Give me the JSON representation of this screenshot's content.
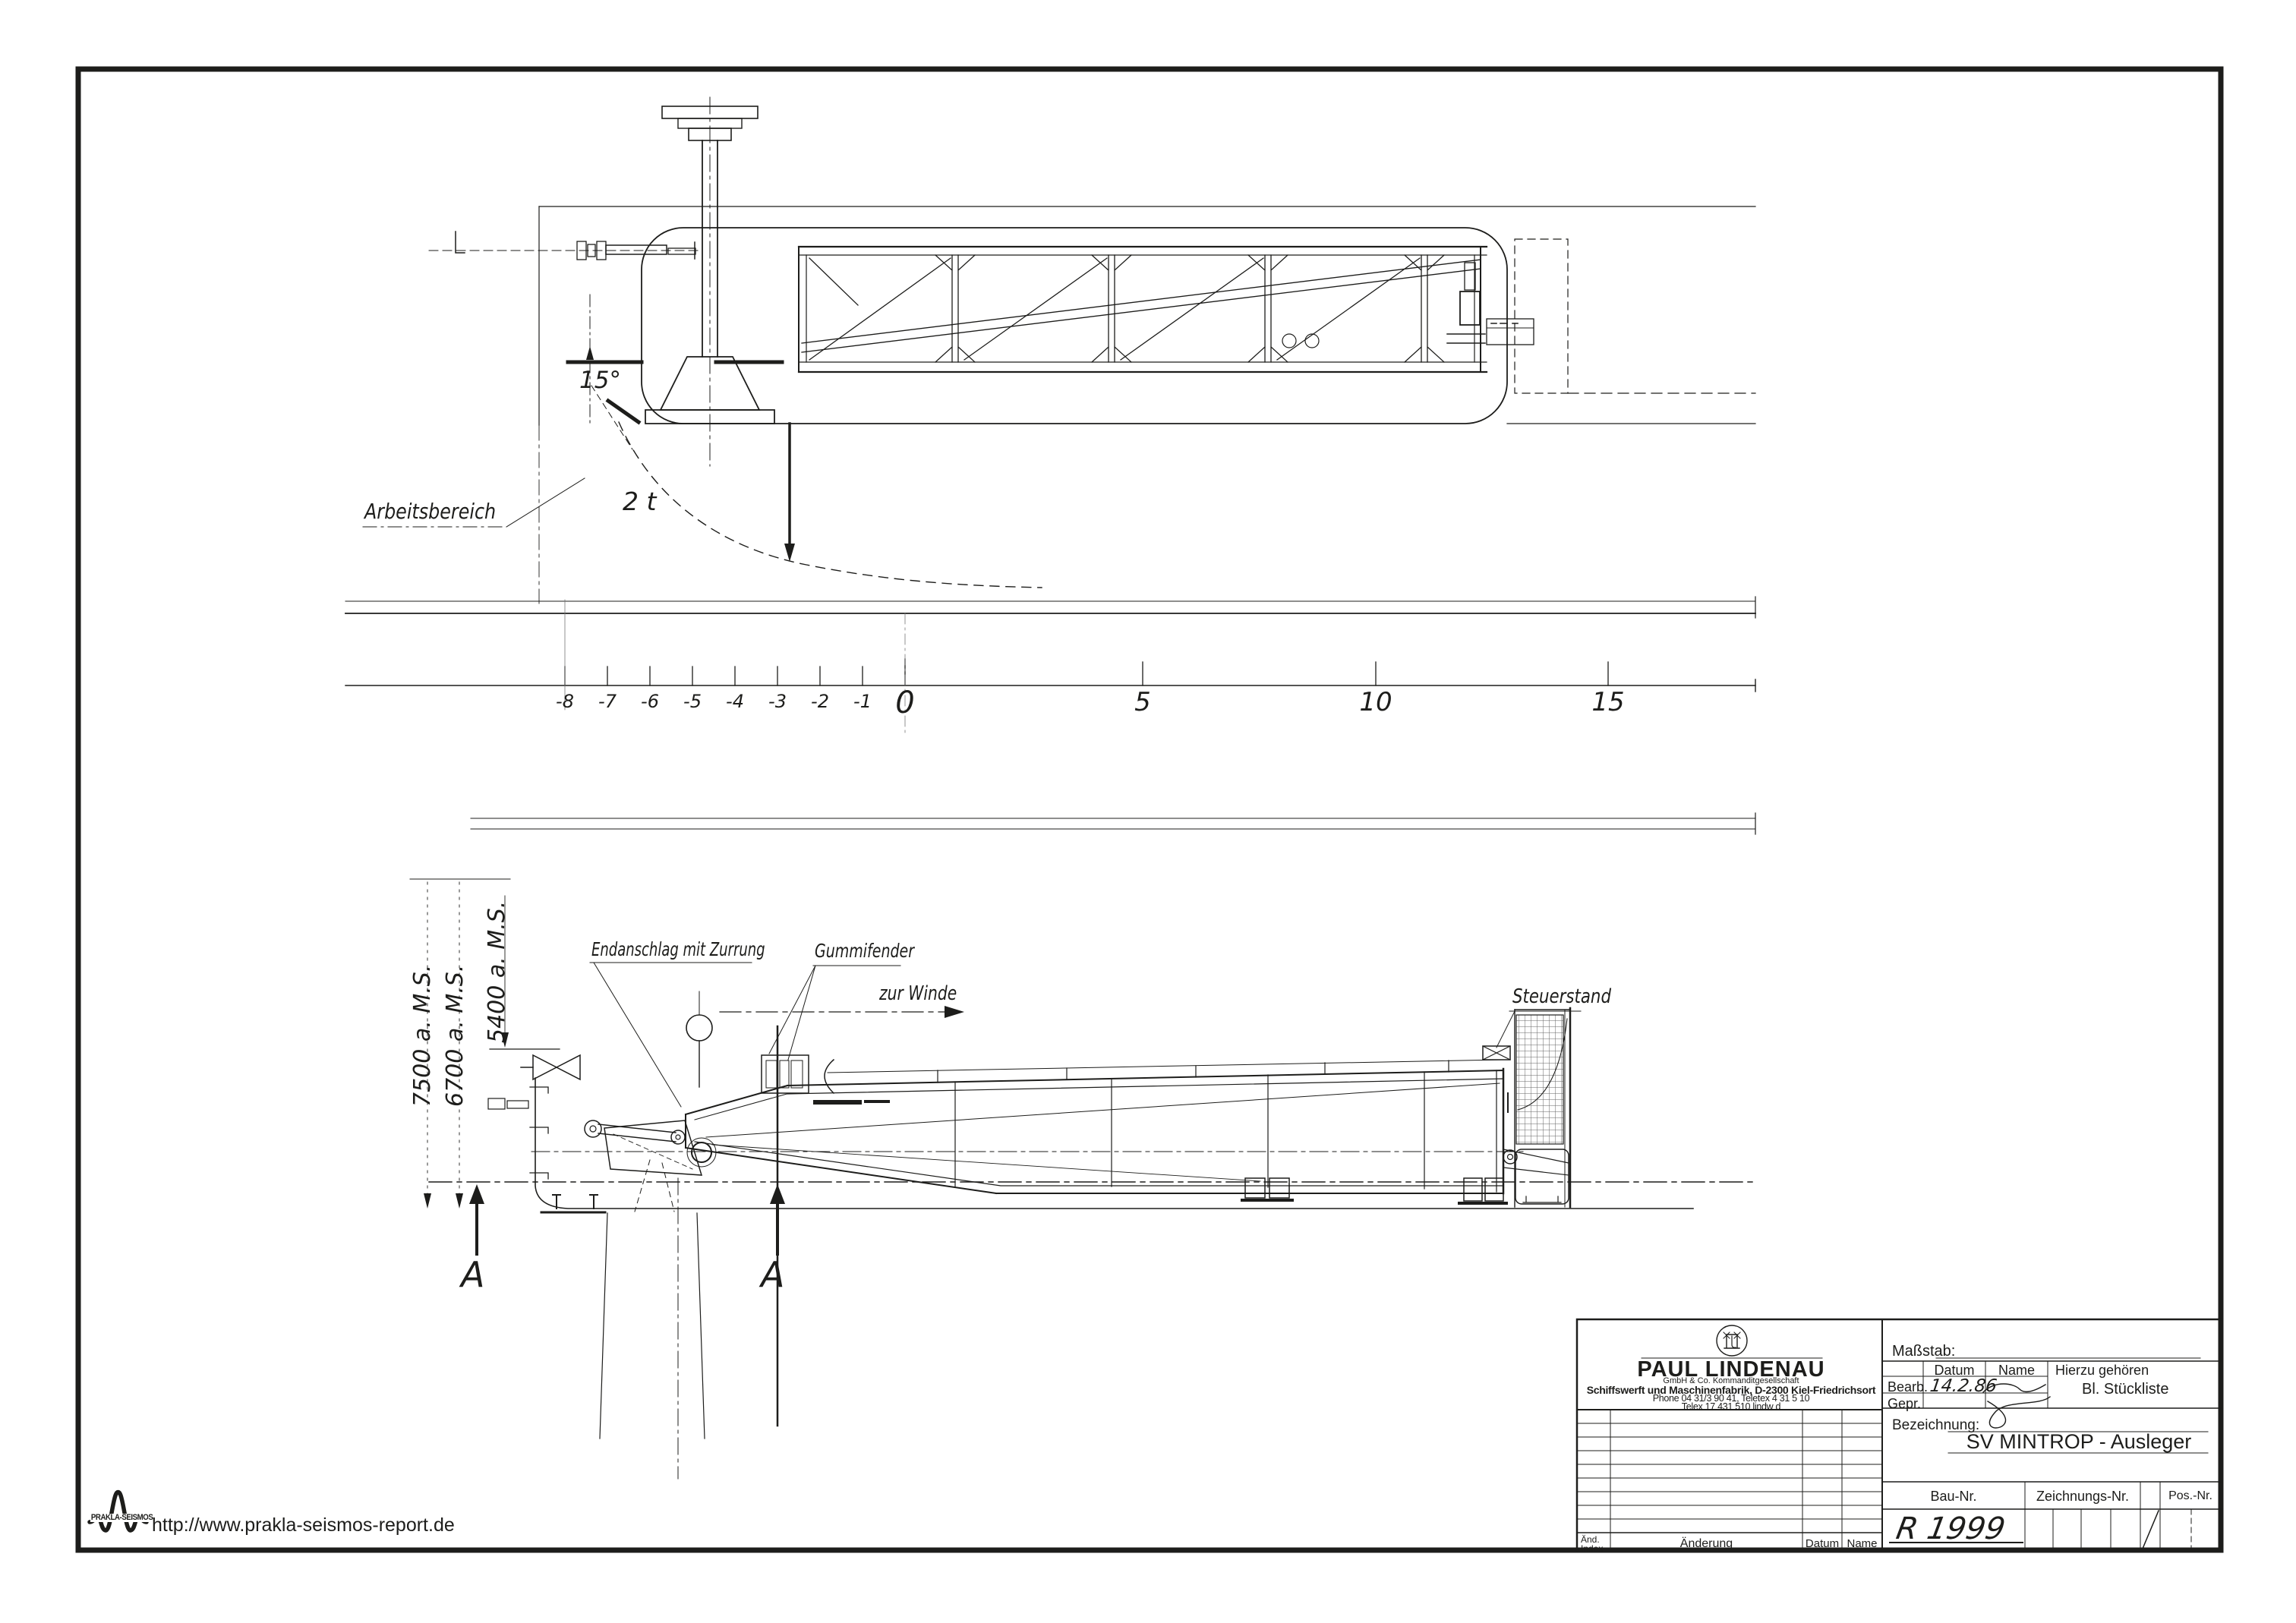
{
  "colors": {
    "ink": "#1d1d1b",
    "paper": "#ffffff"
  },
  "drawing": {
    "annotations": {
      "arbeitsbereich": "Arbeitsbereich",
      "load_capacity": "2 t",
      "slew_angle": "15°",
      "endanschlag": "Endanschlag mit Zurrung",
      "gummifender": "Gummifender",
      "zur_winde": "zur Winde",
      "steuerstand": "Steuerstand",
      "dim_7500": "7500 a. M.S.",
      "dim_6700": "6700 a. M.S.",
      "dim_5400": "5400 a. M.S.",
      "section_left": "A",
      "section_right": "A"
    },
    "ruler": {
      "ticks": [
        {
          "label": "-8"
        },
        {
          "label": "-7"
        },
        {
          "label": "-6"
        },
        {
          "label": "-5"
        },
        {
          "label": "-4"
        },
        {
          "label": "-3"
        },
        {
          "label": "-2"
        },
        {
          "label": "-1"
        },
        {
          "label": "0"
        },
        {
          "label": "5"
        },
        {
          "label": "10"
        },
        {
          "label": "15"
        }
      ]
    }
  },
  "title_block": {
    "company": {
      "name": "PAUL LINDENAU",
      "legal_form": "GmbH & Co. Kommanditgesellschaft",
      "address": "Schiffswerft und Maschinenfabrik, D-2300 Kiel-Friedrichsort",
      "phone": "Phone 04 31/3 90 41, Teletex 4 31 5 10",
      "telex": "Telex 17 431 510 lindw d"
    },
    "fields": {
      "masstab": "Maßstab:",
      "datum": "Datum",
      "name": "Name",
      "hierzu": "Hierzu gehören",
      "bearb": "Bearb.",
      "bearb_datum_value": "14.2.86",
      "gepr": "Gepr.",
      "stueckliste": "Bl. Stückliste",
      "bezeichnung": "Bezeichnung:",
      "bezeichnung_value": "SV MINTROP - Ausleger",
      "bau_nr": "Bau-Nr.",
      "bau_nr_value": "R 1999",
      "zeichnungs_nr": "Zeichnungs-Nr.",
      "pos_nr": "Pos.-Nr."
    },
    "revision": {
      "aend": "Änd.",
      "index": "Index",
      "aenderung": "Änderung",
      "datum": "Datum",
      "name": "Name"
    }
  },
  "footer": {
    "logo_text": "PRAKLA-SEISMOS",
    "url": "http://www.prakla-seismos-report.de"
  }
}
